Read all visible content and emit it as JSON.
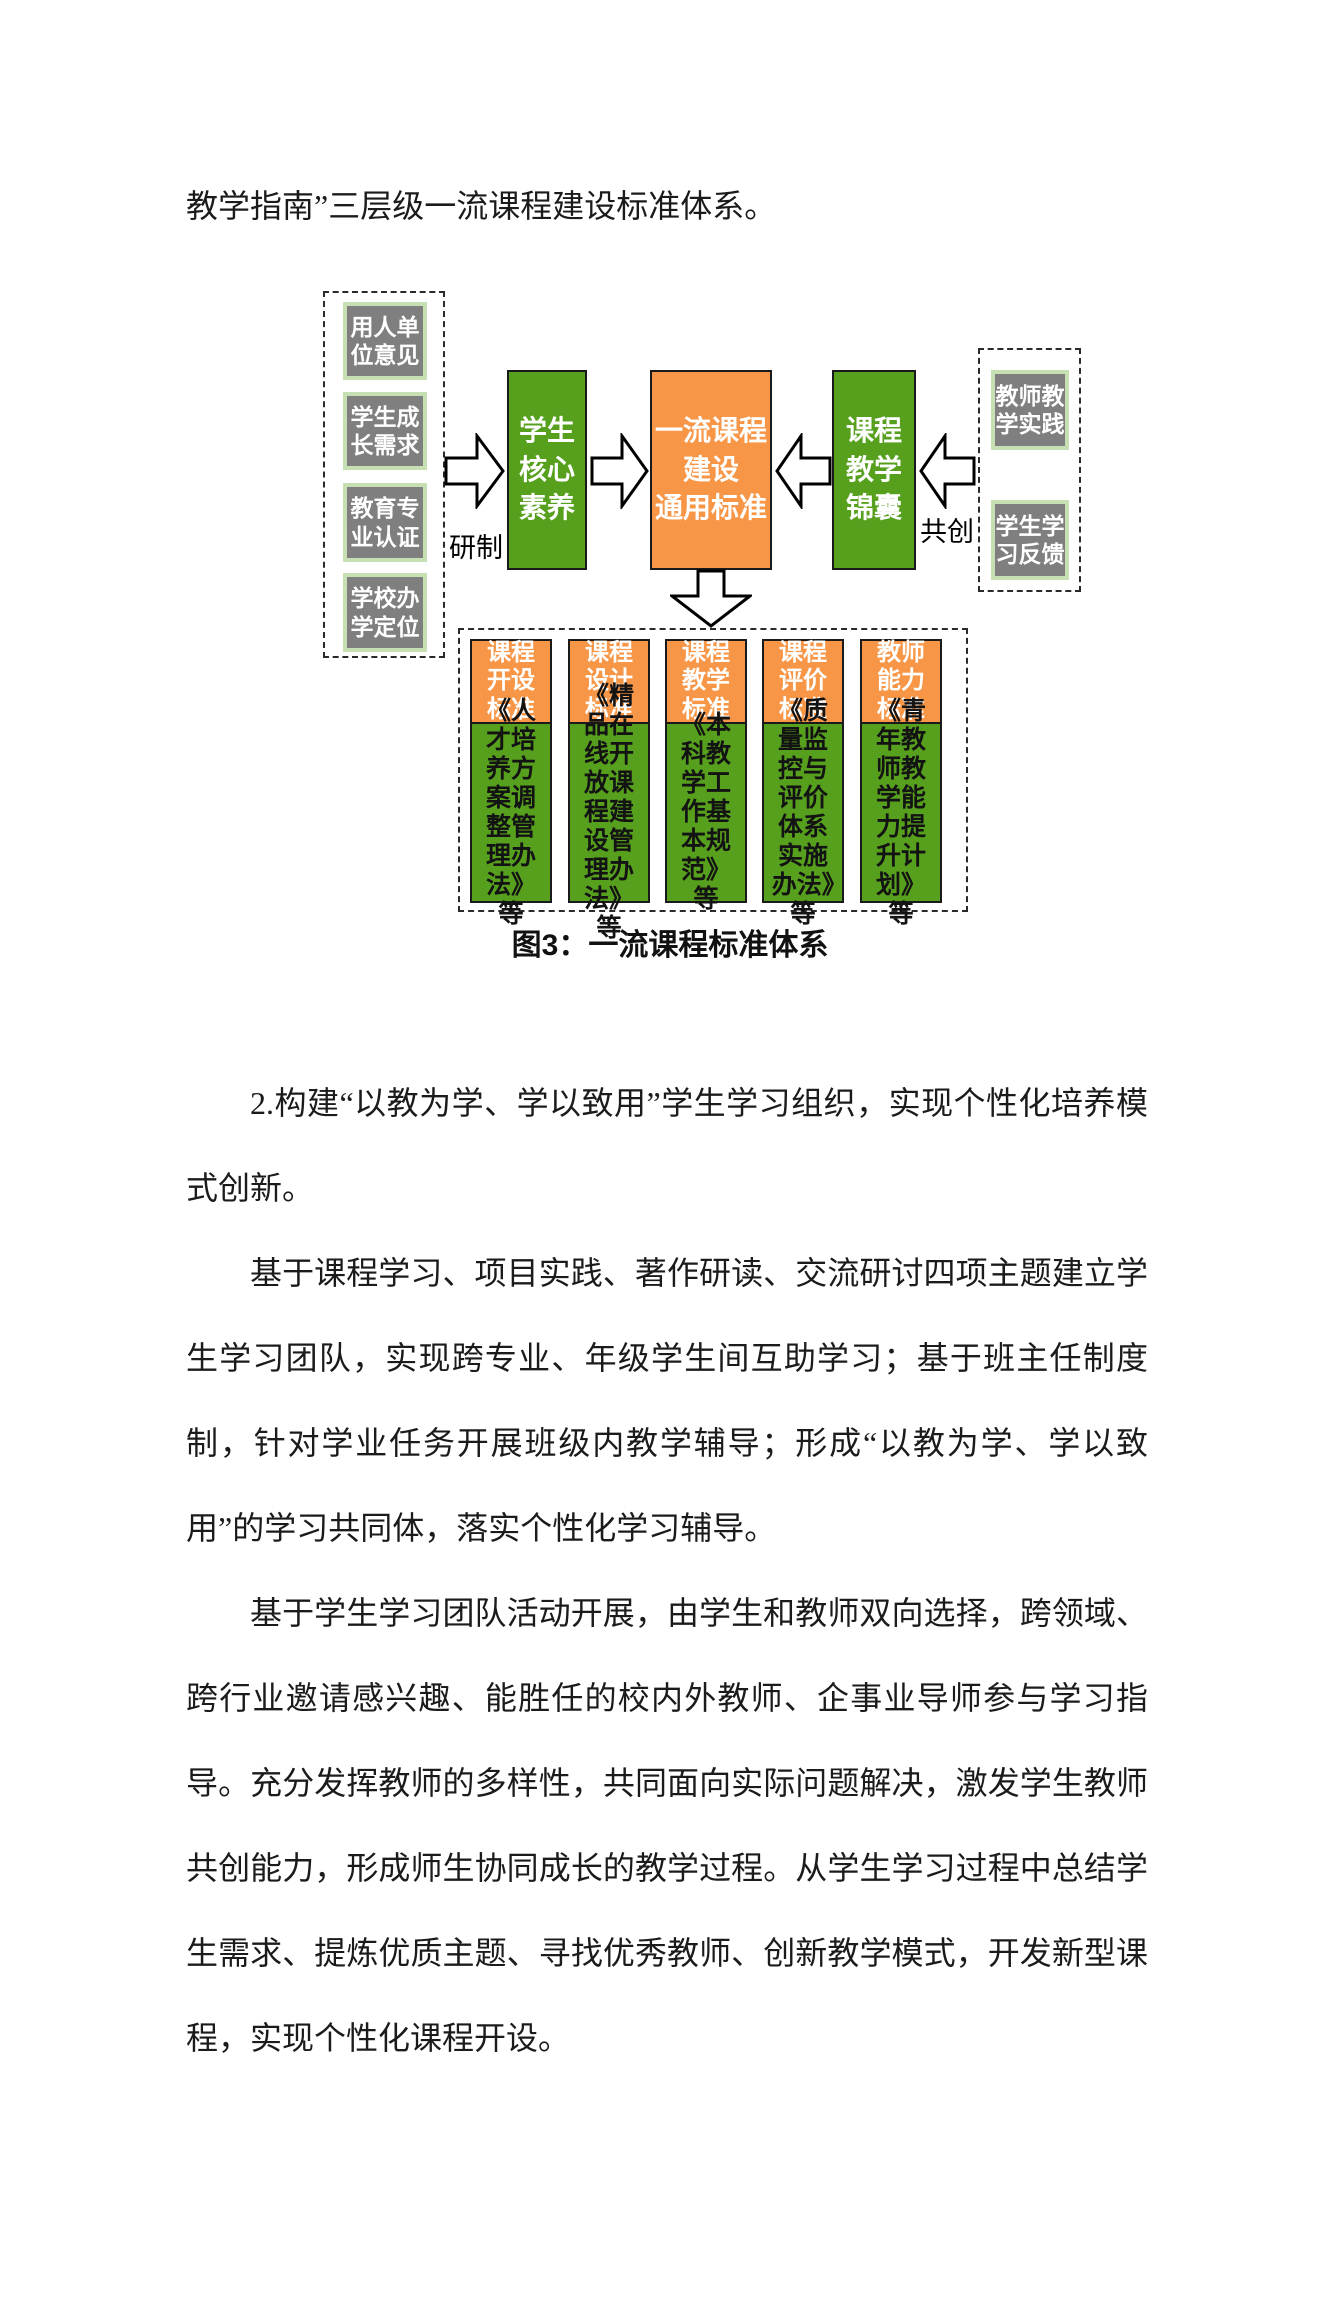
{
  "page": {
    "intro_line": "教学指南”三层级一流课程建设标准体系。",
    "paragraphs": [
      {
        "text": "2.构建“以教为学、学以致用”学生学习组织，实现个性化培养模式创新。"
      },
      {
        "text": "基于课程学习、项目实践、著作研读、交流研讨四项主题建立学生学习团队，实现跨专业、年级学生间互助学习；基于班主任制度制，针对学业任务开展班级内教学辅导；形成“以教为学、学以致用”的学习共同体，落实个性化学习辅导。"
      },
      {
        "text": "基于学生学习团队活动开展，由学生和教师双向选择，跨领域、跨行业邀请感兴趣、能胜任的校内外教师、企事业导师参与学习指导。充分发挥教师的多样性，共同面向实际问题解决，激发学生教师共创能力，形成师生协同成长的教学过程。从学生学习过程中总结学生需求、提炼优质主题、寻找优秀教师、创新教学模式，开发新型课程，实现个性化课程开设。"
      }
    ]
  },
  "diagram": {
    "caption": "图3：一流课程标准体系",
    "left_inputs": [
      "用人单\n位意见",
      "学生成\n长需求",
      "教育专\n业认证",
      "学校办\n学定位"
    ],
    "right_inputs": [
      "教师教\n学实践",
      "学生学\n习反馈"
    ],
    "center": {
      "student_core": "学生\n核心\n素养",
      "main_standard": "一流课程\n建设\n通用标准",
      "course_tips": "课程\n教学\n锦囊"
    },
    "labels": {
      "develop": "研制",
      "cocreate": "共创"
    },
    "columns": [
      {
        "header": "课程\n开设\n标准",
        "body": "《人才培养方案调整管理办法》等"
      },
      {
        "header": "课程\n设计\n标准",
        "body": "《精品在线开放课程建设管理办法》等"
      },
      {
        "header": "课程\n教学\n标准",
        "body": "《本科教学工作基本规范》等"
      },
      {
        "header": "课程\n评价\n标准",
        "body": "《质量监控与评价体系实施办法》等"
      },
      {
        "header": "教师\n能力\n标准",
        "body": "《青年教师教学能力提升计划》等"
      }
    ],
    "colors": {
      "green": "#57a01e",
      "orange": "#f79646",
      "gray": "#7f7f7f",
      "light_green_border": "#c6e0b4"
    }
  }
}
